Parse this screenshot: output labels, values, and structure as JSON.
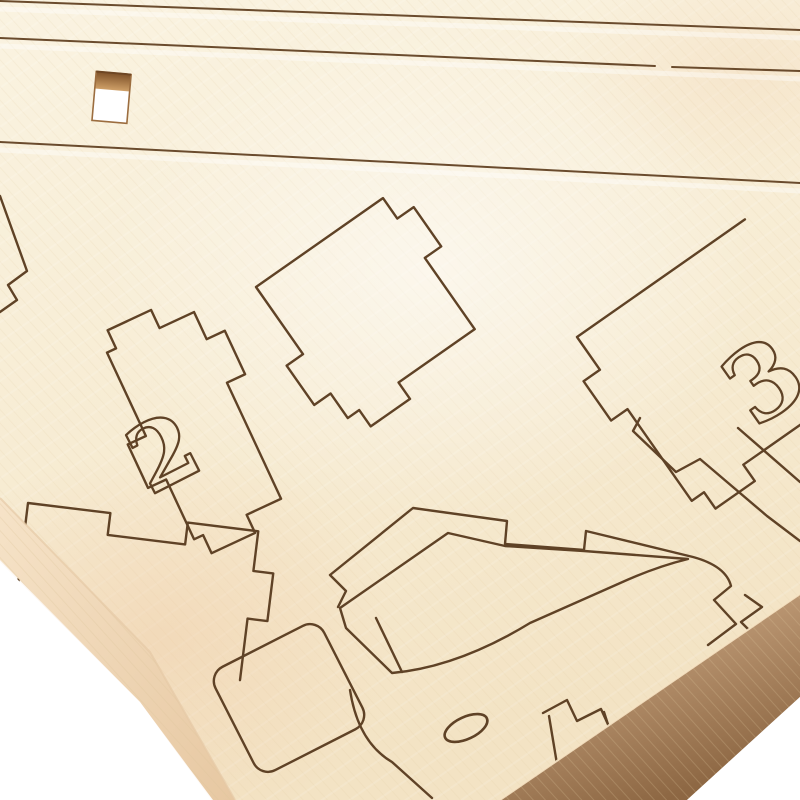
{
  "scene": {
    "kind": "photograph",
    "subject": "Close-up of a laser-cut plywood model-kit sheet with numbered puzzle pieces, tilted on a white studio backdrop",
    "background": "white"
  },
  "sheet": {
    "material_look": "pale birch plywood",
    "engraving": {
      "piece2_label": "2",
      "piece3_label": "3"
    }
  },
  "colors": {
    "background": "#ffffff",
    "wood_face": "#f8efd9",
    "cut_line": "#5f4226",
    "rail_line": "#6a4b2d",
    "edge_left": "#eed3b2",
    "edge_bottom": "#9c7850",
    "hole_lip": "#b9824e"
  }
}
